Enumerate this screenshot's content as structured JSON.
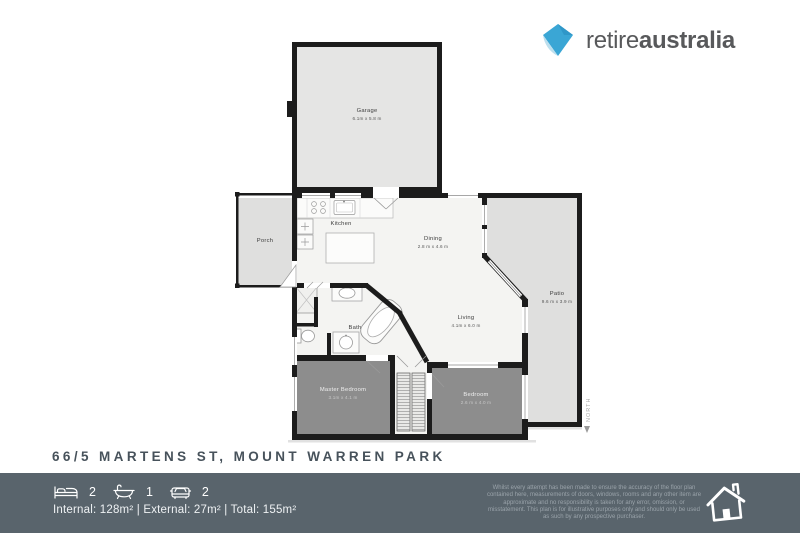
{
  "logo": {
    "brand_regular": "retire",
    "brand_bold": "australia"
  },
  "plan": {
    "rooms": {
      "garage": {
        "name": "Garage",
        "dims": "6.1m x 5.8 m"
      },
      "porch": {
        "name": "Porch"
      },
      "kitchen": {
        "name": "Kitchen"
      },
      "dining": {
        "name": "Dining",
        "dims": "2.8 m x 4.6 m"
      },
      "living": {
        "name": "Living",
        "dims": "4.1m x 6.0 m"
      },
      "patio": {
        "name": "Patio",
        "dims": "9.6 m x 3.9 m"
      },
      "bath": {
        "name": "Bath"
      },
      "master_bedroom": {
        "name": "Master Bedroom",
        "dims": "3.1m x 4.1 m"
      },
      "bedroom": {
        "name": "Bedroom",
        "dims": "2.6 m x 4.0 m"
      }
    },
    "north_label": "NORTH"
  },
  "address": "66/5 MARTENS ST, MOUNT WARREN PARK",
  "footer": {
    "stats": [
      {
        "icon": "bed-icon",
        "value": "2"
      },
      {
        "icon": "bath-icon",
        "value": "1"
      },
      {
        "icon": "car-icon",
        "value": "2"
      }
    ],
    "areas": "Internal: 128m² | External: 27m² | Total: 155m²",
    "disclaimer": "Whilst every attempt has been made to ensure the accuracy of the floor plan contained here, measurements of doors, windows, rooms and any other item are approximate and no responsibility is taken for any error, omission, or misstatement. This plan is for illustrative purposes only and should only be used as such by any prospective purchaser."
  },
  "colors": {
    "footer_band": "#59646c",
    "logo_blue": "#3aa6d5",
    "logo_blue_light": "#bcdfee",
    "wall": "#1c1c1c",
    "outdoor_gray": "#dfdfde",
    "bedroom_gray": "#8d8d8d"
  }
}
